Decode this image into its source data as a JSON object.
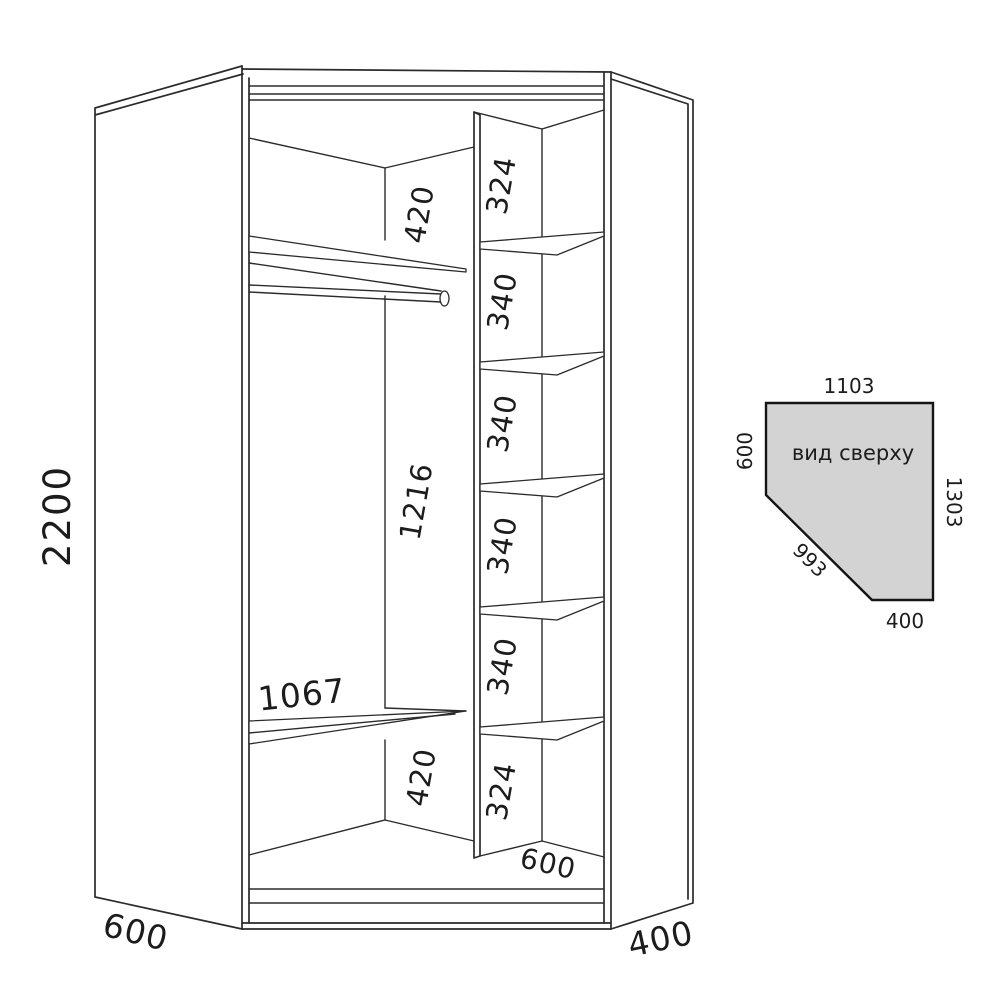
{
  "colors": {
    "line": "#2b2b2b",
    "text": "#1c1c1c",
    "top_view_fill": "#d3d3d3",
    "background": "#ffffff"
  },
  "main_view": {
    "description": "corner wardrobe front perspective drawing",
    "labels": {
      "height": "2200",
      "width_left": "600",
      "width_right": "400",
      "depth_inner": "600",
      "shelf_width": "1067",
      "left_top_gap": "420",
      "left_middle_gap": "1216",
      "left_bottom_gap": "420"
    },
    "shelf_column": [
      "324",
      "340",
      "340",
      "340",
      "340",
      "324"
    ]
  },
  "top_view": {
    "title": "вид сверху",
    "top": "1103",
    "left": "600",
    "right": "1303",
    "diagonal": "993",
    "bottom": "400"
  }
}
